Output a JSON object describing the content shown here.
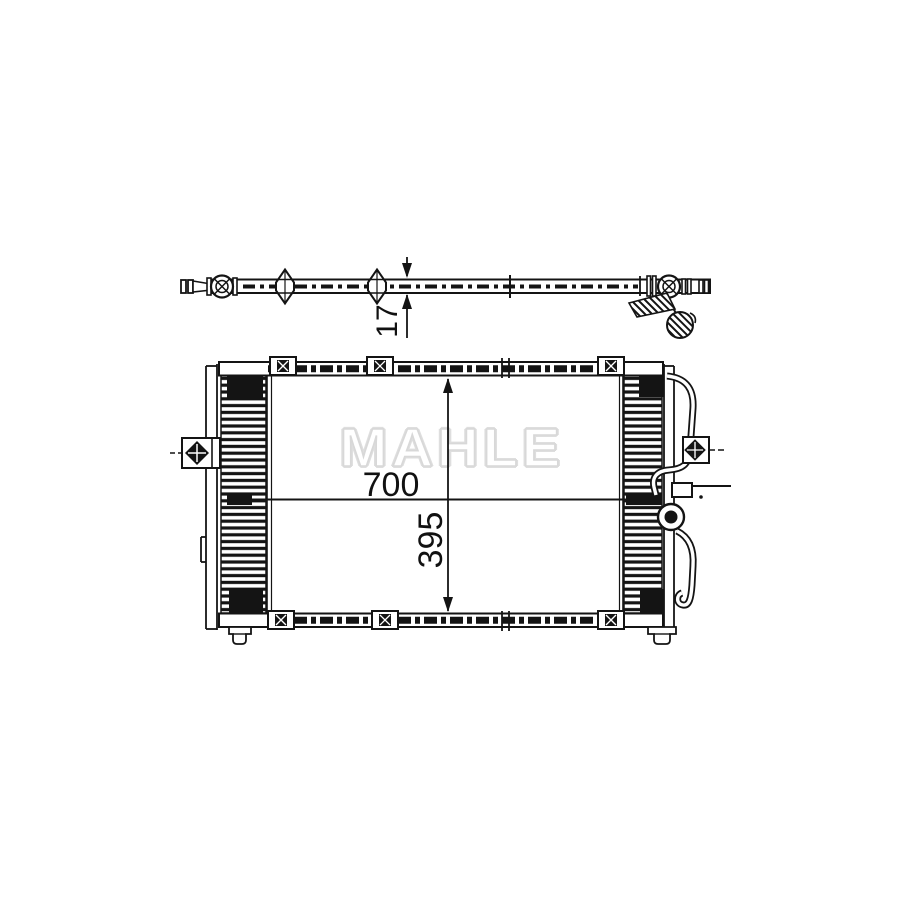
{
  "canvas": {
    "background": "#ffffff",
    "stroke_color": "#141414"
  },
  "watermark": {
    "text": "MAHLE",
    "fill": "#ffffff",
    "outline": "#d8d8d8"
  },
  "top_view": {
    "dimension_thickness": {
      "value": "17",
      "orientation": "rotated-90"
    }
  },
  "front_view": {
    "dimension_width": {
      "value": "700",
      "orientation": "horizontal"
    },
    "dimension_height": {
      "value": "395",
      "orientation": "rotated-90"
    }
  }
}
